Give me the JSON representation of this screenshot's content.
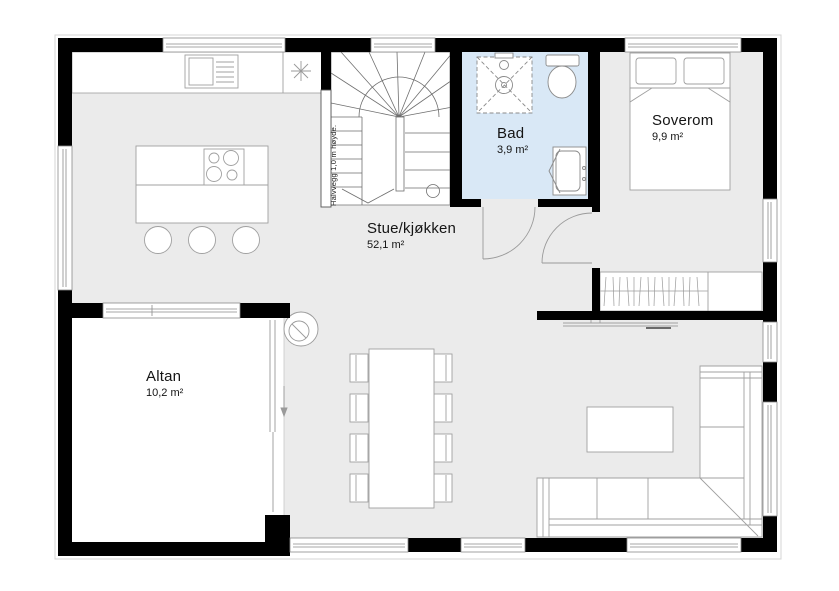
{
  "plan": {
    "type": "floor-plan",
    "rooms": {
      "stue": {
        "name": "Stue/kjøkken",
        "area": "52,1 m²"
      },
      "bad": {
        "name": "Bad",
        "area": "3,9 m²"
      },
      "soverom": {
        "name": "Soverom",
        "area": "9,9 m²"
      },
      "altan": {
        "name": "Altan",
        "area": "10,2 m²"
      }
    },
    "annotations": {
      "half_wall": "Halvvegg 1,0 m høyde."
    },
    "colors": {
      "wall": "#000000",
      "floor_main": "#ebebeb",
      "floor_bath": "#d9e8f6",
      "floor_terrace": "#ffffff",
      "furniture_line": "#a0a0a0",
      "fixture_line": "#8a8a8a"
    }
  }
}
